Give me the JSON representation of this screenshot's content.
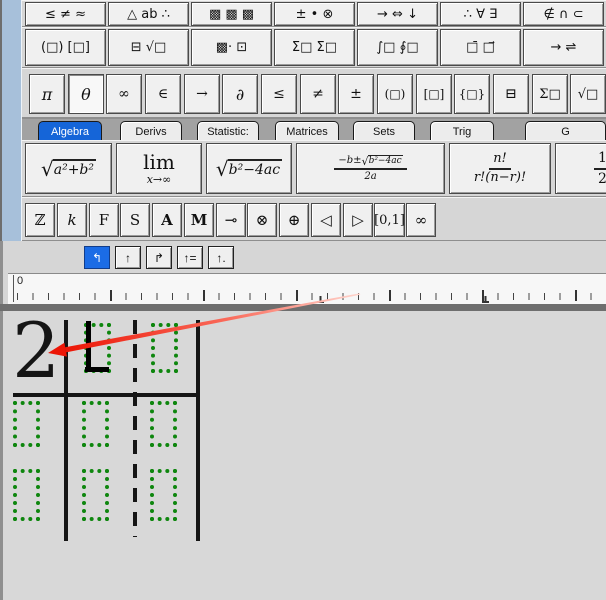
{
  "palette_row1": [
    {
      "label": "≤ ≠ ≈"
    },
    {
      "label": "△ ab ∴"
    },
    {
      "label": "▩ ▩ ▩"
    },
    {
      "label": "± • ⊗"
    },
    {
      "label": "→ ⇔ ↓"
    },
    {
      "label": "∴ ∀ ∃"
    },
    {
      "label": "∉ ∩ ⊂"
    }
  ],
  "palette_row2": [
    {
      "label": "(□) [□]"
    },
    {
      "label": "⊟ √□"
    },
    {
      "label": "▩· ⊡"
    },
    {
      "label": "Σ□ Σ□"
    },
    {
      "label": "∫□ ∮□"
    },
    {
      "label": "□̄ □⃗"
    },
    {
      "label": "→ ⇌"
    }
  ],
  "smallbar": [
    "π",
    "θ",
    "∞",
    "∈",
    "→",
    "∂",
    "≤",
    "≠",
    "±",
    "(□)",
    "[□]",
    "{□}",
    "⊟",
    "Σ□",
    "√□"
  ],
  "smallbar_pressed": "θ",
  "tabs": [
    "Algebra",
    "Derivs",
    "Statistic:",
    "Matrices",
    "Sets",
    "Trig",
    "G"
  ],
  "templates": {
    "t1": {
      "sign": "√",
      "body": "a²+b²"
    },
    "t2": {
      "top": "lim",
      "bottom": "x→∞"
    },
    "t3": {
      "sign": "√",
      "body": "b²−4ac"
    },
    "t4": {
      "num_prefix": "−b±",
      "num_sign": "√",
      "num_rad": "b²−4ac",
      "den": "2a"
    },
    "t5": {
      "num": "n!",
      "den": "r!(n−r)!"
    },
    "t6": {
      "num": "1",
      "den": "2"
    }
  },
  "letters": [
    "ℤ",
    "k",
    "F",
    "S",
    "A",
    "M",
    "⊸",
    "⊗",
    "⊕",
    "◁",
    "▷",
    "[0,1]",
    "∞"
  ],
  "tab_wells": [
    "↰",
    "↑",
    "↱",
    "↑=",
    "↑."
  ],
  "ruler": {
    "origin": "0"
  },
  "equation": {
    "value": "2"
  },
  "colors": {
    "accent_blue": "#1565d8",
    "annotation_red": "#ec1606",
    "placeholder_green": "#0e860e"
  }
}
